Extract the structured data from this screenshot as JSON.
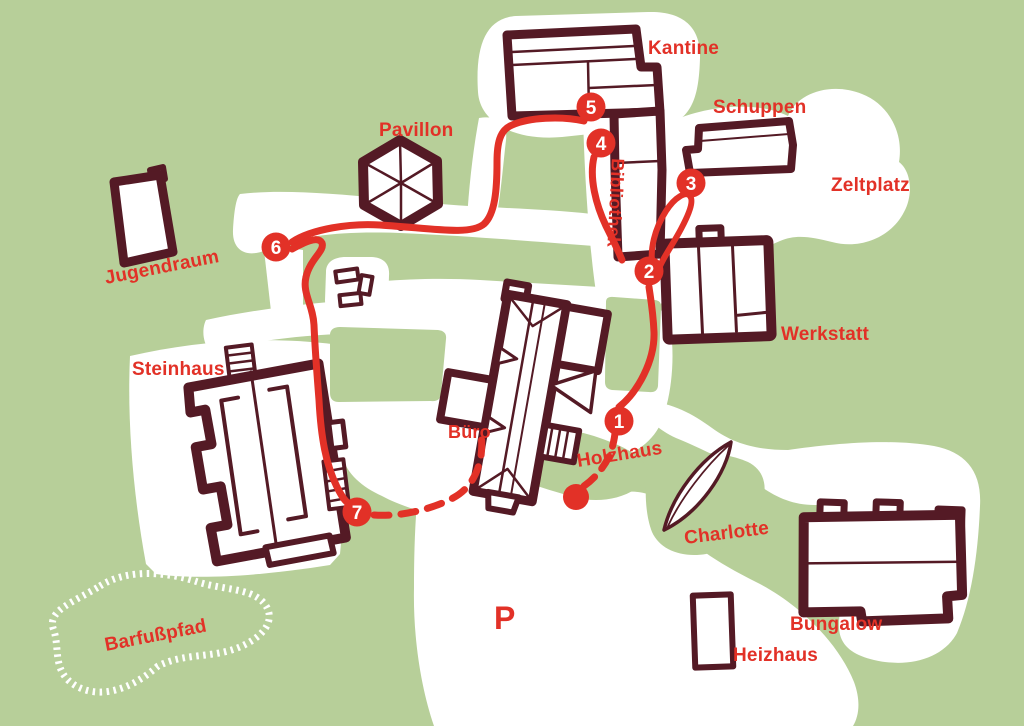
{
  "map": {
    "type": "site-plan",
    "language": "de",
    "colors": {
      "background": "#b7cf99",
      "path": "#ffffff",
      "building": "#541a25",
      "route": "#e23127",
      "waypoint_text": "#ffffff"
    },
    "labels": {
      "kantine": "Kantine",
      "schuppen": "Schuppen",
      "zeltplatz": "Zeltplatz",
      "werkstatt": "Werkstatt",
      "bibliothek": "Bibliothek",
      "pavillon": "Pavillon",
      "jugendraum": "Jugendraum",
      "steinhaus": "Steinhaus",
      "buero": "Büro",
      "holzhaus": "Holzhaus",
      "charlotte": "Charlotte",
      "bungalow": "Bungalow",
      "heizhaus": "Heizhaus",
      "barfusspfad": "Barfußpfad",
      "parking": "P"
    },
    "waypoints": [
      {
        "number": "1"
      },
      {
        "number": "2"
      },
      {
        "number": "3"
      },
      {
        "number": "4"
      },
      {
        "number": "5"
      },
      {
        "number": "6"
      },
      {
        "number": "7"
      }
    ]
  }
}
